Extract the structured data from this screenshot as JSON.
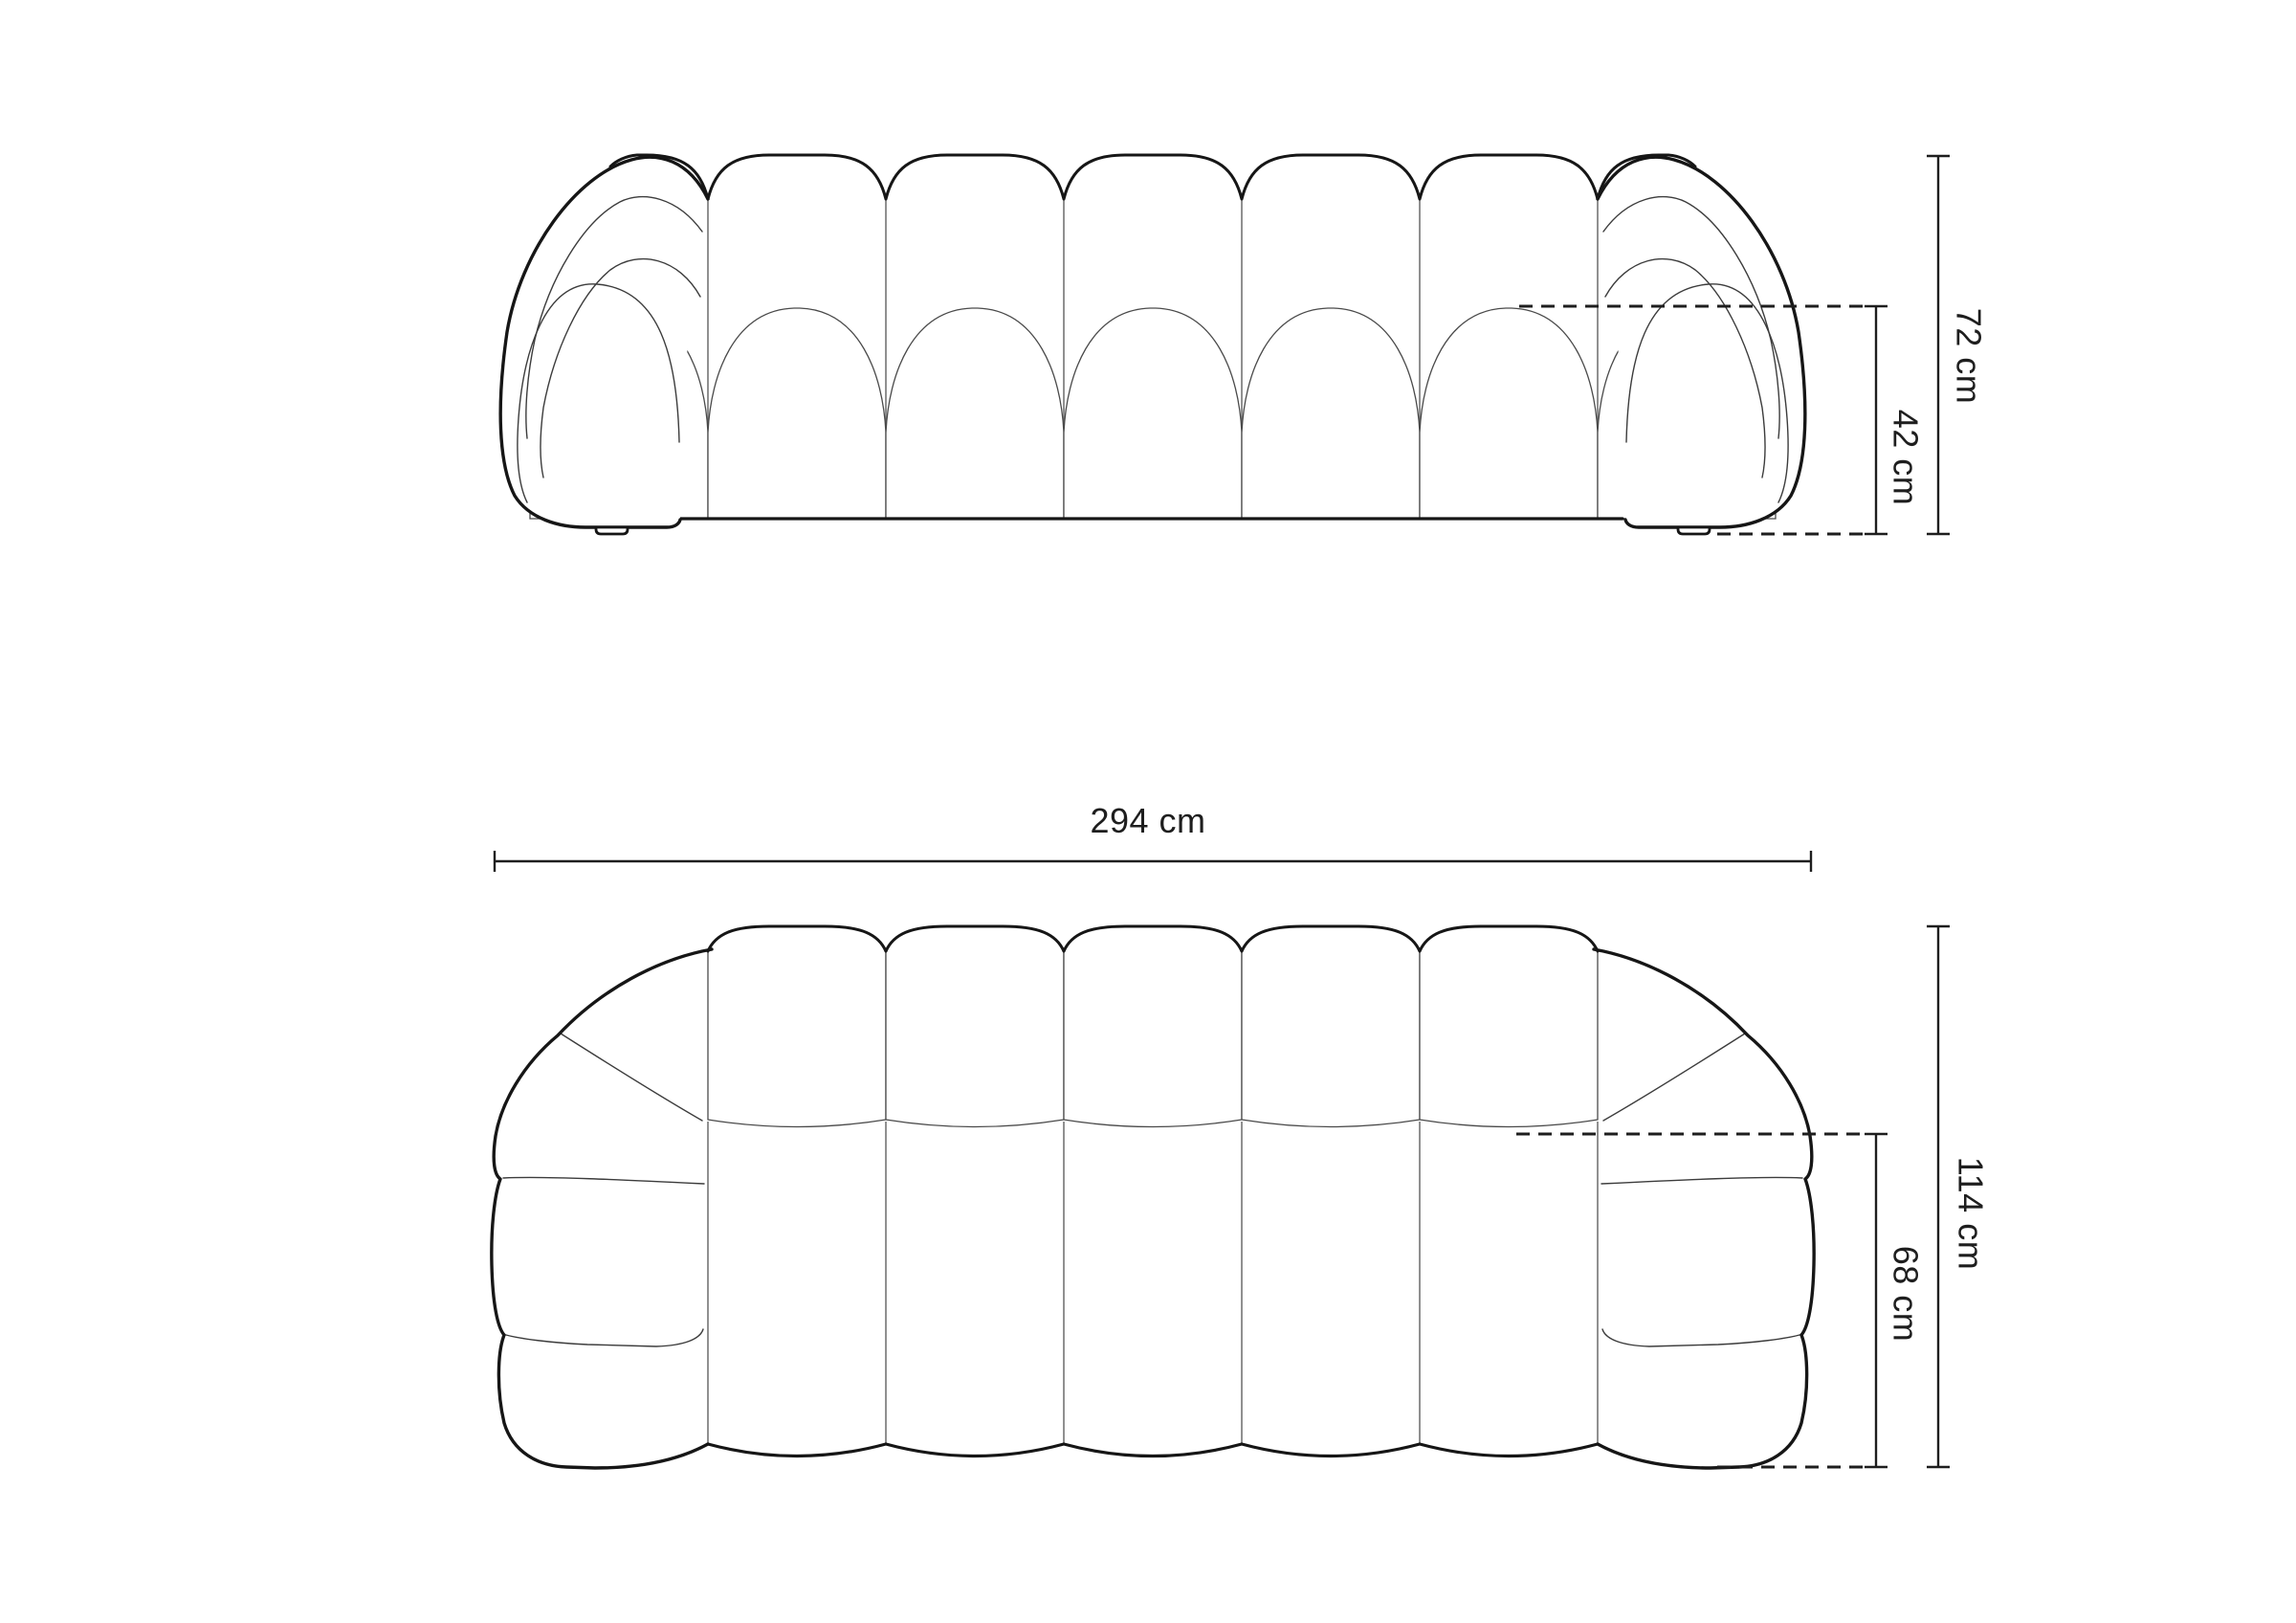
{
  "diagram": {
    "title": "sofa dimension drawing",
    "background_color": "#ffffff",
    "ink_color": "#1e1e1e",
    "front_view": {
      "name": "front elevation of bubble sofa",
      "dims": {
        "total_height": {
          "label": "72 cm",
          "value": 72,
          "unit": "cm"
        },
        "seat_height": {
          "label": "42 cm",
          "value": 42,
          "unit": "cm"
        }
      }
    },
    "plan_view": {
      "name": "top plan of bubble sofa",
      "dims": {
        "total_width": {
          "label": "294 cm",
          "value": 294,
          "unit": "cm"
        },
        "total_depth": {
          "label": "114 cm",
          "value": 114,
          "unit": "cm"
        },
        "seat_depth": {
          "label": "68 cm",
          "value": 68,
          "unit": "cm"
        }
      }
    }
  }
}
